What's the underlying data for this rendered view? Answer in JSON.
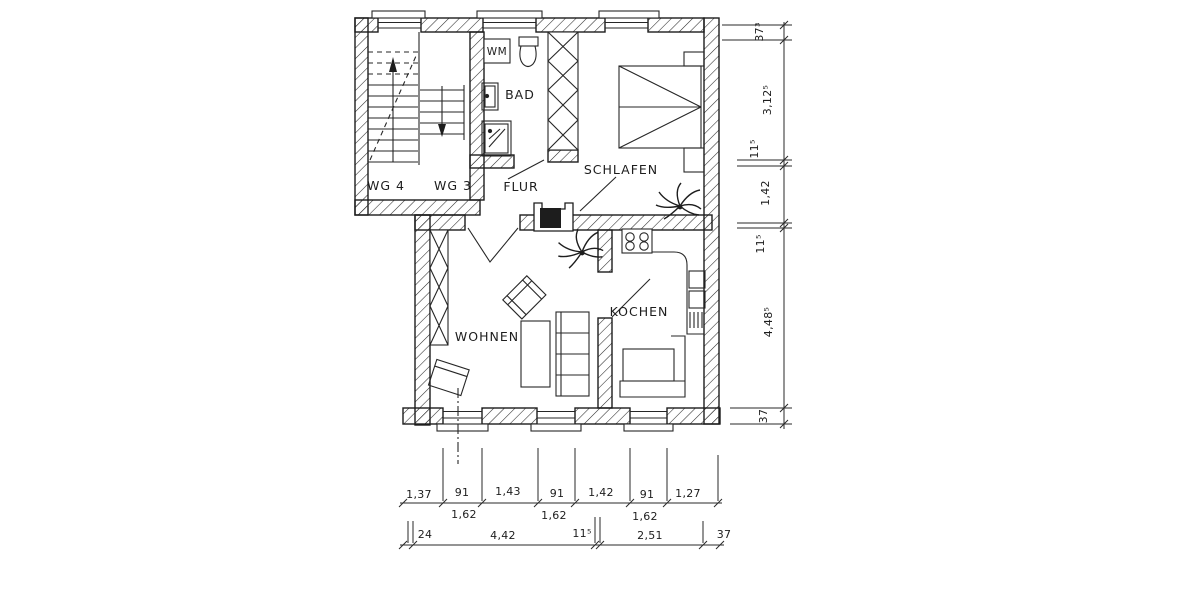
{
  "rooms": {
    "wg4": "WG 4",
    "wg3": "WG 3",
    "flur": "FLUR",
    "bad": "BAD",
    "wm": "WM",
    "schlafen": "SCHLAFEN",
    "wohnen": "WOHNEN",
    "kochen": "KOCHEN"
  },
  "dims": {
    "right": [
      "37³",
      "3,12⁵",
      "11⁵",
      "1,42",
      "11⁵",
      "4,48⁵",
      "37"
    ],
    "bottom_row1": [
      "1,37",
      "91",
      "1,43",
      "91",
      "1,42",
      "91",
      "1,27"
    ],
    "bottom_row1_sub": [
      "1,62",
      "1,62",
      "1,62"
    ],
    "bottom_row2": [
      "24",
      "4,42",
      "11⁵",
      "2,51",
      "37"
    ]
  },
  "colors": {
    "ink": "#1d1d1d",
    "paper": "#ffffff"
  }
}
